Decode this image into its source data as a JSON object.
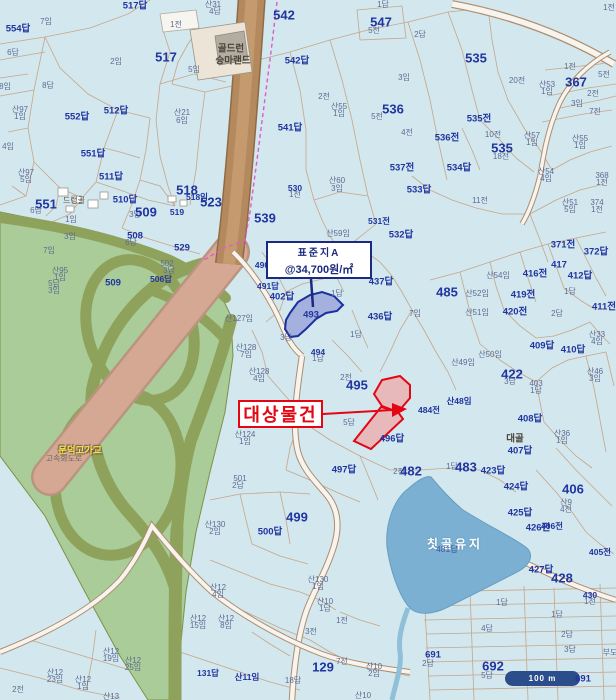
{
  "annotations": {
    "standard_lot_callout": {
      "line1": "표준지A",
      "line2": "@34,700원/㎡"
    },
    "subject_property_label": "대상물건"
  },
  "scale_bar": {
    "label": "100 m"
  },
  "water": {
    "name": "칫골유지"
  },
  "colors": {
    "bg": "#d2e7ee",
    "navy": "#2135a0",
    "sml": "#5f6b93",
    "red": "#e30613",
    "cb": "#1b2a80",
    "sb": "#2b4d8c",
    "water_fill": "#7cb0d2",
    "green": "#a9cc98",
    "olive": "#8ea25c",
    "road_brown": "#b5895e",
    "expressway_pink": "#d5a893",
    "parcel_line": "#c59e7e",
    "boundary_magenta": "#e05ac8"
  },
  "labels": [
    {
      "t": "517답",
      "x": 135,
      "y": 6,
      "c": "num"
    },
    {
      "t": "산31",
      "x": 213,
      "y": 5,
      "c": "s"
    },
    {
      "t": "4답",
      "x": 215,
      "y": 12,
      "c": "s"
    },
    {
      "t": "1전",
      "x": 176,
      "y": 25,
      "c": "s"
    },
    {
      "t": "7임",
      "x": 46,
      "y": 22,
      "c": "s"
    },
    {
      "t": "554답",
      "x": 18,
      "y": 29,
      "c": "num"
    },
    {
      "t": "6답",
      "x": 13,
      "y": 53,
      "c": "s"
    },
    {
      "t": "골드런",
      "x": 231,
      "y": 49,
      "c": "place"
    },
    {
      "t": "승마랜드",
      "x": 233,
      "y": 61,
      "c": "place"
    },
    {
      "t": "517",
      "x": 166,
      "y": 57,
      "c": "big"
    },
    {
      "t": "2임",
      "x": 116,
      "y": 62,
      "c": "s"
    },
    {
      "t": "5임",
      "x": 194,
      "y": 70,
      "c": "s"
    },
    {
      "t": "542",
      "x": 284,
      "y": 15,
      "c": "big"
    },
    {
      "t": "542답",
      "x": 297,
      "y": 61,
      "c": "num"
    },
    {
      "t": "8답",
      "x": 48,
      "y": 86,
      "c": "s"
    },
    {
      "t": "8임",
      "x": 5,
      "y": 87,
      "c": "s"
    },
    {
      "t": "산97",
      "x": 20,
      "y": 110,
      "c": "s"
    },
    {
      "t": "1임",
      "x": 20,
      "y": 117,
      "c": "s"
    },
    {
      "t": "552답",
      "x": 77,
      "y": 117,
      "c": "num"
    },
    {
      "t": "512답",
      "x": 116,
      "y": 111,
      "c": "num"
    },
    {
      "t": "산21",
      "x": 182,
      "y": 113,
      "c": "s"
    },
    {
      "t": "6임",
      "x": 182,
      "y": 121,
      "c": "s"
    },
    {
      "t": "541답",
      "x": 290,
      "y": 128,
      "c": "num"
    },
    {
      "t": "4임",
      "x": 8,
      "y": 147,
      "c": "s"
    },
    {
      "t": "551답",
      "x": 93,
      "y": 154,
      "c": "num"
    },
    {
      "t": "산97",
      "x": 26,
      "y": 173,
      "c": "s"
    },
    {
      "t": "5임",
      "x": 26,
      "y": 180,
      "c": "s"
    },
    {
      "t": "511답",
      "x": 111,
      "y": 177,
      "c": "num"
    },
    {
      "t": "551",
      "x": 46,
      "y": 204,
      "c": "big"
    },
    {
      "t": "6답",
      "x": 36,
      "y": 211,
      "c": "s"
    },
    {
      "t": "드랭골",
      "x": 74,
      "y": 201,
      "c": "place-s"
    },
    {
      "t": "510답",
      "x": 125,
      "y": 200,
      "c": "num"
    },
    {
      "t": "3답",
      "x": 135,
      "y": 215,
      "c": "s"
    },
    {
      "t": "509",
      "x": 146,
      "y": 212,
      "c": "big"
    },
    {
      "t": "1임",
      "x": 71,
      "y": 220,
      "c": "s"
    },
    {
      "t": "518",
      "x": 187,
      "y": 190,
      "c": "big"
    },
    {
      "t": "518임",
      "x": 197,
      "y": 197,
      "c": "nums"
    },
    {
      "t": "523",
      "x": 211,
      "y": 202,
      "c": "big"
    },
    {
      "t": "519",
      "x": 177,
      "y": 212,
      "c": "nums"
    },
    {
      "t": "539",
      "x": 265,
      "y": 218,
      "c": "big"
    },
    {
      "t": "3임",
      "x": 70,
      "y": 237,
      "c": "s"
    },
    {
      "t": "508",
      "x": 135,
      "y": 236,
      "c": "num"
    },
    {
      "t": "6답",
      "x": 131,
      "y": 243,
      "c": "s"
    },
    {
      "t": "7임",
      "x": 49,
      "y": 251,
      "c": "s"
    },
    {
      "t": "529",
      "x": 182,
      "y": 248,
      "c": "num"
    },
    {
      "t": "502",
      "x": 167,
      "y": 264,
      "c": "s"
    },
    {
      "t": "3답",
      "x": 169,
      "y": 271,
      "c": "s"
    },
    {
      "t": "산95",
      "x": 60,
      "y": 271,
      "c": "s"
    },
    {
      "t": "1임",
      "x": 60,
      "y": 278,
      "c": "s"
    },
    {
      "t": "506답",
      "x": 161,
      "y": 279,
      "c": "nums"
    },
    {
      "t": "5답",
      "x": 54,
      "y": 284,
      "c": "s"
    },
    {
      "t": "3임",
      "x": 54,
      "y": 291,
      "c": "s"
    },
    {
      "t": "509",
      "x": 113,
      "y": 283,
      "c": "num"
    },
    {
      "t": "530",
      "x": 295,
      "y": 188,
      "c": "nums"
    },
    {
      "t": "1전",
      "x": 295,
      "y": 195,
      "c": "s"
    },
    {
      "t": "산60",
      "x": 337,
      "y": 181,
      "c": "s"
    },
    {
      "t": "3임",
      "x": 337,
      "y": 189,
      "c": "s"
    },
    {
      "t": "산59임",
      "x": 338,
      "y": 234,
      "c": "s"
    },
    {
      "t": "531전",
      "x": 379,
      "y": 221,
      "c": "nums"
    },
    {
      "t": "1답",
      "x": 383,
      "y": 5,
      "c": "s"
    },
    {
      "t": "547",
      "x": 381,
      "y": 22,
      "c": "big"
    },
    {
      "t": "5전",
      "x": 374,
      "y": 31,
      "c": "s"
    },
    {
      "t": "2답",
      "x": 420,
      "y": 35,
      "c": "s"
    },
    {
      "t": "535",
      "x": 476,
      "y": 58,
      "c": "big"
    },
    {
      "t": "1전",
      "x": 609,
      "y": 8,
      "c": "s"
    },
    {
      "t": "3임",
      "x": 404,
      "y": 78,
      "c": "s"
    },
    {
      "t": "2전",
      "x": 324,
      "y": 97,
      "c": "s"
    },
    {
      "t": "산55",
      "x": 339,
      "y": 107,
      "c": "s"
    },
    {
      "t": "1임",
      "x": 339,
      "y": 114,
      "c": "s"
    },
    {
      "t": "536",
      "x": 393,
      "y": 109,
      "c": "big"
    },
    {
      "t": "5전",
      "x": 377,
      "y": 117,
      "c": "s"
    },
    {
      "t": "4전",
      "x": 407,
      "y": 133,
      "c": "s"
    },
    {
      "t": "20전",
      "x": 517,
      "y": 81,
      "c": "s"
    },
    {
      "t": "산53",
      "x": 547,
      "y": 85,
      "c": "s"
    },
    {
      "t": "1임",
      "x": 547,
      "y": 92,
      "c": "s"
    },
    {
      "t": "1전",
      "x": 570,
      "y": 67,
      "c": "s"
    },
    {
      "t": "367",
      "x": 576,
      "y": 82,
      "c": "big"
    },
    {
      "t": "5전",
      "x": 604,
      "y": 75,
      "c": "s"
    },
    {
      "t": "2전",
      "x": 593,
      "y": 94,
      "c": "s"
    },
    {
      "t": "3임",
      "x": 577,
      "y": 104,
      "c": "s"
    },
    {
      "t": "7전",
      "x": 595,
      "y": 112,
      "c": "s"
    },
    {
      "t": "535전",
      "x": 479,
      "y": 119,
      "c": "num"
    },
    {
      "t": "10전",
      "x": 493,
      "y": 135,
      "c": "s"
    },
    {
      "t": "536전",
      "x": 447,
      "y": 138,
      "c": "num"
    },
    {
      "t": "535",
      "x": 502,
      "y": 148,
      "c": "big"
    },
    {
      "t": "18전",
      "x": 501,
      "y": 157,
      "c": "s"
    },
    {
      "t": "산57",
      "x": 532,
      "y": 136,
      "c": "s"
    },
    {
      "t": "1임",
      "x": 532,
      "y": 143,
      "c": "s"
    },
    {
      "t": "산55",
      "x": 580,
      "y": 139,
      "c": "s"
    },
    {
      "t": "1임",
      "x": 580,
      "y": 146,
      "c": "s"
    },
    {
      "t": "537전",
      "x": 402,
      "y": 168,
      "c": "num"
    },
    {
      "t": "534답",
      "x": 459,
      "y": 168,
      "c": "num"
    },
    {
      "t": "산54",
      "x": 546,
      "y": 172,
      "c": "s"
    },
    {
      "t": "4임",
      "x": 546,
      "y": 179,
      "c": "s"
    },
    {
      "t": "368",
      "x": 602,
      "y": 176,
      "c": "s"
    },
    {
      "t": "1전",
      "x": 602,
      "y": 183,
      "c": "s"
    },
    {
      "t": "533답",
      "x": 419,
      "y": 190,
      "c": "num"
    },
    {
      "t": "11전",
      "x": 480,
      "y": 201,
      "c": "s"
    },
    {
      "t": "산51",
      "x": 570,
      "y": 203,
      "c": "s"
    },
    {
      "t": "5임",
      "x": 570,
      "y": 210,
      "c": "s"
    },
    {
      "t": "374",
      "x": 597,
      "y": 203,
      "c": "s"
    },
    {
      "t": "1전",
      "x": 597,
      "y": 210,
      "c": "s"
    },
    {
      "t": "532답",
      "x": 401,
      "y": 235,
      "c": "num"
    },
    {
      "t": "490",
      "x": 262,
      "y": 265,
      "c": "nums"
    },
    {
      "t": "491답",
      "x": 268,
      "y": 286,
      "c": "nums"
    },
    {
      "t": "402답",
      "x": 282,
      "y": 297,
      "c": "num"
    },
    {
      "t": "493",
      "x": 311,
      "y": 315,
      "c": "num"
    },
    {
      "t": "437답",
      "x": 381,
      "y": 282,
      "c": "num"
    },
    {
      "t": "1답",
      "x": 337,
      "y": 294,
      "c": "s"
    },
    {
      "t": "436답",
      "x": 380,
      "y": 317,
      "c": "num"
    },
    {
      "t": "산127임",
      "x": 239,
      "y": 319,
      "c": "s"
    },
    {
      "t": "3답",
      "x": 286,
      "y": 338,
      "c": "s"
    },
    {
      "t": "1답",
      "x": 356,
      "y": 335,
      "c": "s"
    },
    {
      "t": "산128",
      "x": 246,
      "y": 348,
      "c": "s"
    },
    {
      "t": "7임",
      "x": 246,
      "y": 355,
      "c": "s"
    },
    {
      "t": "494",
      "x": 318,
      "y": 352,
      "c": "nums"
    },
    {
      "t": "1답",
      "x": 318,
      "y": 359,
      "c": "s"
    },
    {
      "t": "산128",
      "x": 259,
      "y": 372,
      "c": "s"
    },
    {
      "t": "4임",
      "x": 259,
      "y": 379,
      "c": "s"
    },
    {
      "t": "2전",
      "x": 346,
      "y": 378,
      "c": "s"
    },
    {
      "t": "495",
      "x": 357,
      "y": 385,
      "c": "big"
    },
    {
      "t": "5답",
      "x": 349,
      "y": 423,
      "c": "s"
    },
    {
      "t": "484전",
      "x": 429,
      "y": 410,
      "c": "nums"
    },
    {
      "t": "산48임",
      "x": 459,
      "y": 401,
      "c": "nums"
    },
    {
      "t": "496답",
      "x": 392,
      "y": 439,
      "c": "num"
    },
    {
      "t": "산124",
      "x": 245,
      "y": 435,
      "c": "s"
    },
    {
      "t": "1임",
      "x": 245,
      "y": 442,
      "c": "s"
    },
    {
      "t": "497답",
      "x": 344,
      "y": 470,
      "c": "num"
    },
    {
      "t": "371전",
      "x": 563,
      "y": 245,
      "c": "num"
    },
    {
      "t": "372답",
      "x": 596,
      "y": 252,
      "c": "num"
    },
    {
      "t": "417",
      "x": 559,
      "y": 265,
      "c": "num"
    },
    {
      "t": "416전",
      "x": 535,
      "y": 274,
      "c": "num"
    },
    {
      "t": "412답",
      "x": 580,
      "y": 276,
      "c": "num"
    },
    {
      "t": "485",
      "x": 447,
      "y": 292,
      "c": "big"
    },
    {
      "t": "산54임",
      "x": 498,
      "y": 276,
      "c": "s"
    },
    {
      "t": "419전",
      "x": 523,
      "y": 295,
      "c": "num"
    },
    {
      "t": "산52임",
      "x": 477,
      "y": 294,
      "c": "s"
    },
    {
      "t": "1답",
      "x": 570,
      "y": 292,
      "c": "s"
    },
    {
      "t": "411전",
      "x": 604,
      "y": 307,
      "c": "num"
    },
    {
      "t": "산51임",
      "x": 477,
      "y": 313,
      "c": "s"
    },
    {
      "t": "420전",
      "x": 515,
      "y": 312,
      "c": "num"
    },
    {
      "t": "2답",
      "x": 557,
      "y": 314,
      "c": "s"
    },
    {
      "t": "7임",
      "x": 415,
      "y": 314,
      "c": "s"
    },
    {
      "t": "산33",
      "x": 597,
      "y": 335,
      "c": "s"
    },
    {
      "t": "4임",
      "x": 597,
      "y": 342,
      "c": "s"
    },
    {
      "t": "409답",
      "x": 542,
      "y": 346,
      "c": "num"
    },
    {
      "t": "410답",
      "x": 573,
      "y": 350,
      "c": "num"
    },
    {
      "t": "산50임",
      "x": 490,
      "y": 355,
      "c": "s"
    },
    {
      "t": "산49임",
      "x": 463,
      "y": 363,
      "c": "s"
    },
    {
      "t": "422",
      "x": 512,
      "y": 374,
      "c": "big"
    },
    {
      "t": "3답",
      "x": 510,
      "y": 382,
      "c": "s"
    },
    {
      "t": "403",
      "x": 536,
      "y": 384,
      "c": "s"
    },
    {
      "t": "1답",
      "x": 536,
      "y": 391,
      "c": "s"
    },
    {
      "t": "산46",
      "x": 595,
      "y": 372,
      "c": "s"
    },
    {
      "t": "3임",
      "x": 595,
      "y": 379,
      "c": "s"
    },
    {
      "t": "408답",
      "x": 530,
      "y": 419,
      "c": "num"
    },
    {
      "t": "대골",
      "x": 515,
      "y": 439,
      "c": "place"
    },
    {
      "t": "407답",
      "x": 520,
      "y": 451,
      "c": "num"
    },
    {
      "t": "산36",
      "x": 562,
      "y": 434,
      "c": "s"
    },
    {
      "t": "1임",
      "x": 562,
      "y": 441,
      "c": "s"
    },
    {
      "t": "501",
      "x": 240,
      "y": 479,
      "c": "s"
    },
    {
      "t": "2답",
      "x": 238,
      "y": 486,
      "c": "s"
    },
    {
      "t": "499",
      "x": 297,
      "y": 517,
      "c": "big"
    },
    {
      "t": "500답",
      "x": 270,
      "y": 532,
      "c": "num"
    },
    {
      "t": "산130",
      "x": 215,
      "y": 525,
      "c": "s"
    },
    {
      "t": "2임",
      "x": 215,
      "y": 532,
      "c": "s"
    },
    {
      "t": "문덕고가교",
      "x": 80,
      "y": 451,
      "c": "roadlbl"
    },
    {
      "t": "고속화도로",
      "x": 64,
      "y": 459,
      "c": "roadsub"
    },
    {
      "t": "산12",
      "x": 218,
      "y": 588,
      "c": "s"
    },
    {
      "t": "4임",
      "x": 218,
      "y": 595,
      "c": "s"
    },
    {
      "t": "산130",
      "x": 318,
      "y": 580,
      "c": "s"
    },
    {
      "t": "1임",
      "x": 318,
      "y": 587,
      "c": "s"
    },
    {
      "t": "산10",
      "x": 325,
      "y": 602,
      "c": "s"
    },
    {
      "t": "1답",
      "x": 325,
      "y": 609,
      "c": "s"
    },
    {
      "t": "1전",
      "x": 342,
      "y": 621,
      "c": "s"
    },
    {
      "t": "3전",
      "x": 311,
      "y": 632,
      "c": "s"
    },
    {
      "t": "산12",
      "x": 198,
      "y": 619,
      "c": "s"
    },
    {
      "t": "15임",
      "x": 198,
      "y": 626,
      "c": "s"
    },
    {
      "t": "산12",
      "x": 226,
      "y": 619,
      "c": "s"
    },
    {
      "t": "8임",
      "x": 226,
      "y": 626,
      "c": "s"
    },
    {
      "t": "131답",
      "x": 208,
      "y": 673,
      "c": "nums"
    },
    {
      "t": "산11임",
      "x": 247,
      "y": 677,
      "c": "nums"
    },
    {
      "t": "18답",
      "x": 293,
      "y": 681,
      "c": "s"
    },
    {
      "t": "산12",
      "x": 111,
      "y": 652,
      "c": "s"
    },
    {
      "t": "19임",
      "x": 111,
      "y": 659,
      "c": "s"
    },
    {
      "t": "산12",
      "x": 133,
      "y": 661,
      "c": "s"
    },
    {
      "t": "25임",
      "x": 133,
      "y": 668,
      "c": "s"
    },
    {
      "t": "산12",
      "x": 55,
      "y": 673,
      "c": "s"
    },
    {
      "t": "23임",
      "x": 55,
      "y": 680,
      "c": "s"
    },
    {
      "t": "산12",
      "x": 83,
      "y": 680,
      "c": "s"
    },
    {
      "t": "1임",
      "x": 83,
      "y": 687,
      "c": "s"
    },
    {
      "t": "2전",
      "x": 18,
      "y": 690,
      "c": "s"
    },
    {
      "t": "산13",
      "x": 111,
      "y": 697,
      "c": "s"
    },
    {
      "t": "129",
      "x": 323,
      "y": 667,
      "c": "big"
    },
    {
      "t": "7전",
      "x": 342,
      "y": 662,
      "c": "s"
    },
    {
      "t": "산10",
      "x": 374,
      "y": 667,
      "c": "s"
    },
    {
      "t": "2임",
      "x": 374,
      "y": 674,
      "c": "s"
    },
    {
      "t": "산10",
      "x": 363,
      "y": 696,
      "c": "s"
    },
    {
      "t": "2전",
      "x": 399,
      "y": 472,
      "c": "s"
    },
    {
      "t": "482",
      "x": 411,
      "y": 471,
      "c": "big"
    },
    {
      "t": "1답",
      "x": 452,
      "y": 467,
      "c": "s"
    },
    {
      "t": "483",
      "x": 466,
      "y": 467,
      "c": "big"
    },
    {
      "t": "423답",
      "x": 493,
      "y": 471,
      "c": "num"
    },
    {
      "t": "424답",
      "x": 516,
      "y": 487,
      "c": "num"
    },
    {
      "t": "425답",
      "x": 520,
      "y": 513,
      "c": "num"
    },
    {
      "t": "426전",
      "x": 538,
      "y": 528,
      "c": "num"
    },
    {
      "t": "406전",
      "x": 552,
      "y": 526,
      "c": "nums"
    },
    {
      "t": "406",
      "x": 573,
      "y": 489,
      "c": "big"
    },
    {
      "t": "산9",
      "x": 566,
      "y": 503,
      "c": "s"
    },
    {
      "t": "4전",
      "x": 566,
      "y": 510,
      "c": "s"
    },
    {
      "t": "405전",
      "x": 600,
      "y": 552,
      "c": "nums"
    },
    {
      "t": "427답",
      "x": 541,
      "y": 570,
      "c": "num"
    },
    {
      "t": "428",
      "x": 562,
      "y": 578,
      "c": "big"
    },
    {
      "t": "430",
      "x": 590,
      "y": 595,
      "c": "nums"
    },
    {
      "t": "1전",
      "x": 590,
      "y": 602,
      "c": "s"
    },
    {
      "t": "칫골유지",
      "x": 455,
      "y": 544,
      "c": "water"
    },
    {
      "t": "481답",
      "x": 447,
      "y": 549,
      "c": "wnum"
    },
    {
      "t": "1답",
      "x": 502,
      "y": 603,
      "c": "s"
    },
    {
      "t": "4답",
      "x": 487,
      "y": 629,
      "c": "s"
    },
    {
      "t": "691",
      "x": 433,
      "y": 655,
      "c": "num"
    },
    {
      "t": "2답",
      "x": 428,
      "y": 664,
      "c": "s"
    },
    {
      "t": "692",
      "x": 493,
      "y": 666,
      "c": "big"
    },
    {
      "t": "5답",
      "x": 487,
      "y": 676,
      "c": "s"
    },
    {
      "t": "1답",
      "x": 557,
      "y": 615,
      "c": "s"
    },
    {
      "t": "2답",
      "x": 567,
      "y": 635,
      "c": "s"
    },
    {
      "t": "3답",
      "x": 570,
      "y": 650,
      "c": "s"
    },
    {
      "t": "부도",
      "x": 610,
      "y": 653,
      "c": "s"
    },
    {
      "t": "691",
      "x": 583,
      "y": 679,
      "c": "num"
    }
  ]
}
